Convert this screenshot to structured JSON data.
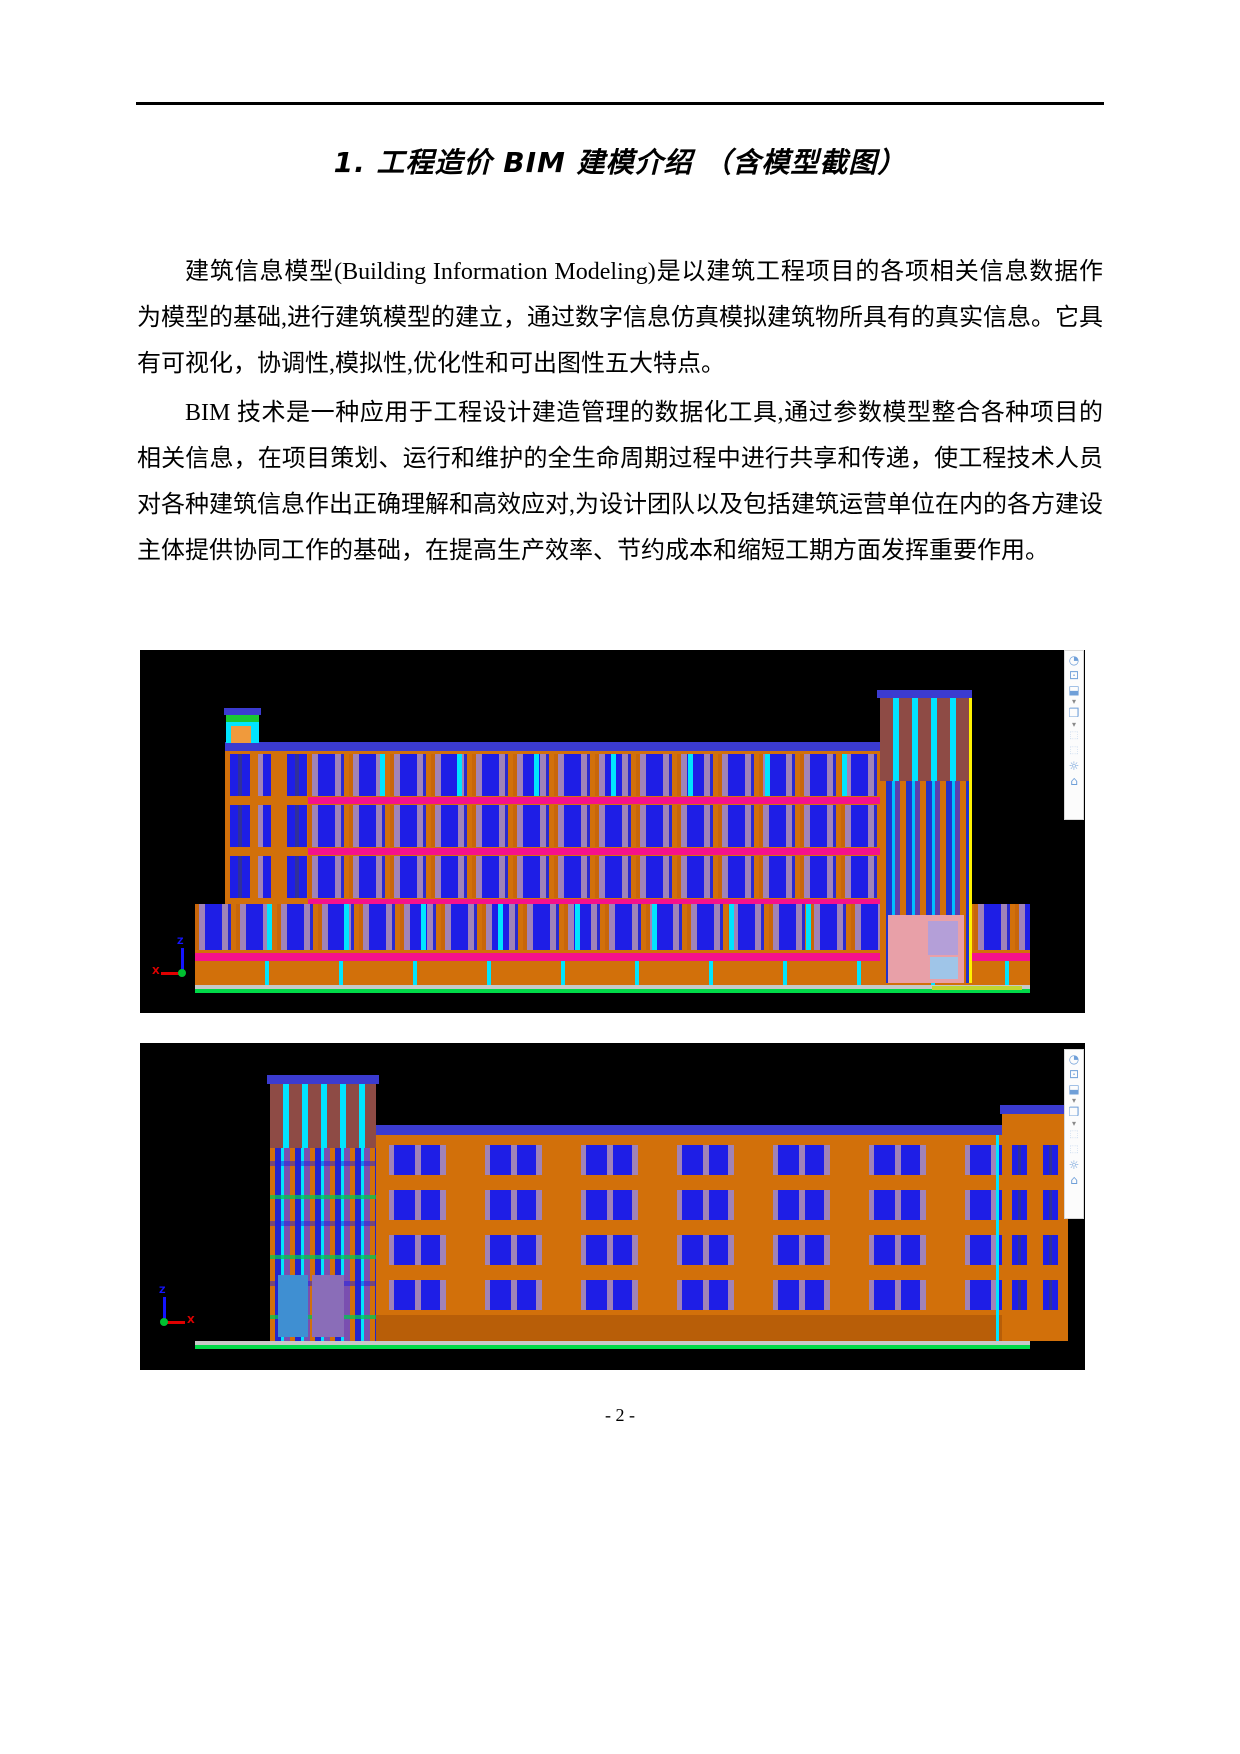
{
  "document": {
    "title": "1. 工程造价 BIM 建模介绍 （含模型截图）",
    "paragraphs": [
      "建筑信息模型(Building Information Modeling)是以建筑工程项目的各项相关信息数据作为模型的基础,进行建筑模型的建立，通过数字信息仿真模拟建筑物所具有的真实信息。它具有可视化，协调性,模拟性,优化性和可出图性五大特点。",
      "BIM 技术是一种应用于工程设计建造管理的数据化工具,通过参数模型整合各种项目的相关信息，在项目策划、运行和维护的全生命周期过程中进行共享和传递，使工程技术人员对各种建筑信息作出正确理解和高效应对,为设计团队以及包括建筑运营单位在内的各方建设主体提供协同工作的基础，在提高生产效率、节约成本和缩短工期方面发挥重要作用。",
      "期方面发挥重要作用。"
    ],
    "page_number": "- 2 -"
  },
  "figures": {
    "fig1": {
      "axis": {
        "x": "X",
        "z": "Z"
      }
    },
    "fig2": {
      "axis": {
        "x": "X",
        "z": "Z"
      }
    }
  },
  "navbar": {
    "icons": [
      {
        "name": "steering-wheel-icon",
        "glyph": "◔"
      },
      {
        "name": "zoom-2d-icon",
        "glyph": "⊡"
      },
      {
        "name": "section-box-icon",
        "glyph": "⬓"
      },
      {
        "name": "dropdown-arrow-icon",
        "glyph": "▾"
      },
      {
        "name": "view-cube-icon",
        "glyph": "❒"
      },
      {
        "name": "dropdown-arrow-icon",
        "glyph": "▾"
      },
      {
        "name": "placeholder-icon",
        "glyph": "⬚"
      },
      {
        "name": "placeholder-icon",
        "glyph": "⬚"
      },
      {
        "name": "sun-shading-icon",
        "glyph": "☼"
      },
      {
        "name": "home-icon",
        "glyph": "⌂"
      }
    ]
  },
  "colors": {
    "facade_orange": "#D2700A",
    "window_blue": "#1E1EE6",
    "mullion_cyan": "#00E5FF",
    "floor_band_magenta": "#F5118C",
    "roof_band_blue": "#3B3BD0",
    "tower_maroon": "#8E4B45",
    "panel_mauve": "#A083B8",
    "ground_green": "#00D948",
    "slab_gray": "#C8C8C8",
    "edge_yellow": "#FFF200",
    "panel_pink": "#E8A0A8",
    "navbar_icon_blue": "#6F9FD8"
  }
}
